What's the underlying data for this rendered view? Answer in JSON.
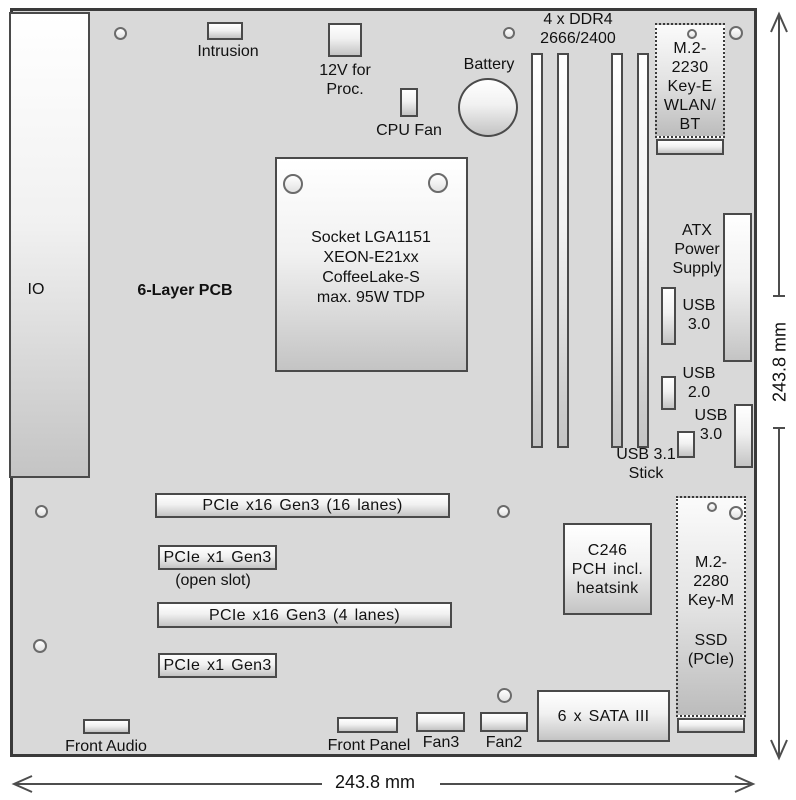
{
  "colors": {
    "board_fill": "#d9d9d9",
    "board_outline": "#3a3a3a",
    "component_border": "#4a4a4a",
    "text": "#111111"
  },
  "board": {
    "io": "IO",
    "pcb_type": "6-Layer PCB"
  },
  "top_area": {
    "intrusion": "Intrusion",
    "power_12v": "12V for\nProc.",
    "cpu_fan": "CPU Fan",
    "battery": "Battery",
    "ddr4": "4 x DDR4\n2666/2400",
    "m2_2230": "M.2-\n2230\nKey-E\nWLAN/\nBT"
  },
  "right_area": {
    "atx": "ATX\nPower\nSupply",
    "usb30_a": "USB\n3.0",
    "usb20": "USB\n2.0",
    "usb30_b": "USB\n3.0",
    "usb31_stick": "USB 3.1\nStick"
  },
  "cpu": {
    "socket": "Socket LGA1151\nXEON-E21xx\nCoffeeLake-S\nmax. 95W TDP"
  },
  "pcie": {
    "x16_16": "PCIe x16 Gen3 (16 lanes)",
    "x1_open": "PCIe x1 Gen3",
    "open_note": "(open slot)",
    "x16_4": "PCIe x16 Gen3 (4 lanes)",
    "x1": "PCIe x1 Gen3"
  },
  "bottom_area": {
    "c246": "C246\nPCH incl.\nheatsink",
    "m2_2280_top": "M.2-\n2280\nKey-M",
    "m2_2280_bottom": "SSD\n(PCIe)",
    "sata": "6 x SATA III",
    "front_audio": "Front Audio",
    "front_panel": "Front Panel",
    "fan3": "Fan3",
    "fan2": "Fan2"
  },
  "dimensions": {
    "width": "243.8 mm",
    "height": "243.8 mm"
  }
}
